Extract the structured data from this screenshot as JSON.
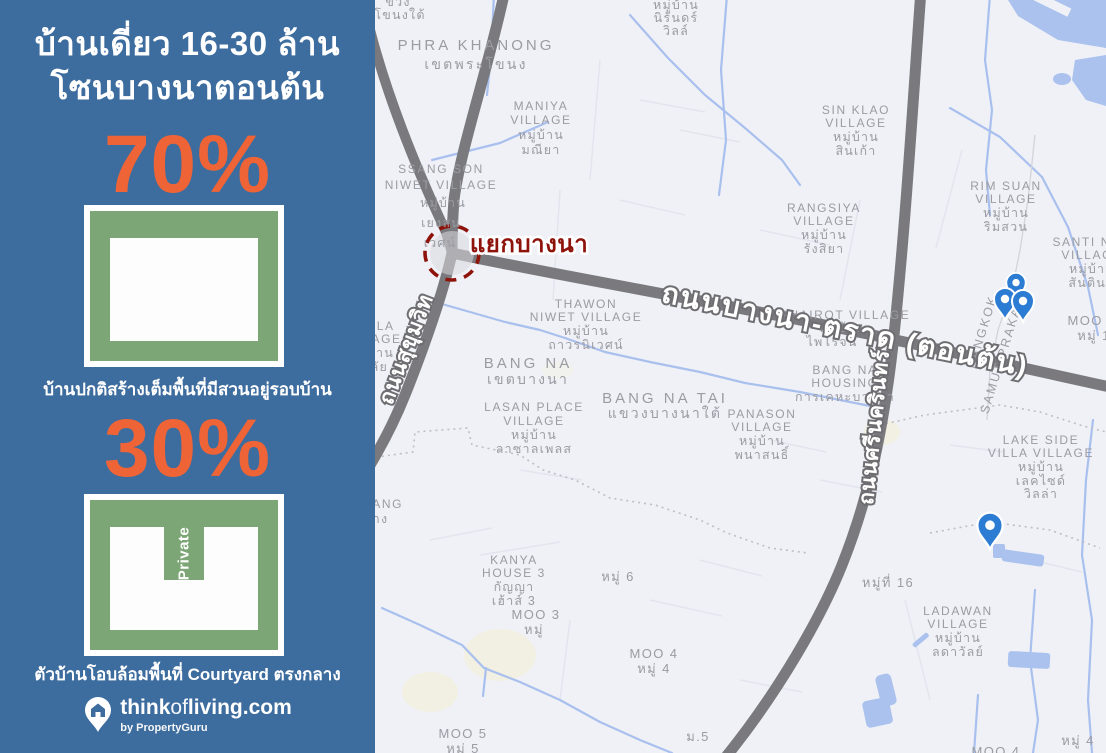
{
  "panel": {
    "title": {
      "line1": "บ้านเดี่ยว 16-30 ล้าน",
      "line2": "โซนบางนาตอนต้น"
    },
    "stats": [
      {
        "percent": "70%",
        "caption": "บ้านปกติสร้างเต็มพื้นที่มีสวนอยู่รอบบ้าน"
      },
      {
        "percent": "30%",
        "caption": "ตัวบ้านโอบล้อมพื้นที่ Courtyard ตรงกลาง",
        "courtyard_label": "Private"
      }
    ],
    "logo": {
      "part_bold1": "think",
      "part_light": "of",
      "part_bold2": "living",
      "part_domain": ".com",
      "byline": "by PropertyGuru"
    }
  },
  "map": {
    "junction": {
      "label": "แยกบางนา"
    },
    "roads": {
      "bangna_trat": "ถนนบางนา-ตราด (ตอนต้น)",
      "sukhumvit": "ถนนสุขุมวิท",
      "srinagarindra": "ถนนศรีนครินทร์"
    },
    "boundary": {
      "bangkok": "BANGKOK",
      "samut_prakan": "SAMUT PRAKAN"
    },
    "labels": {
      "phra_khanong_tai": [
        "ขวง",
        "โขนงใต้"
      ],
      "phra_khanong": [
        "PHRA KHANONG",
        "เขตพระโขนง"
      ],
      "maniya": [
        "MANIYA",
        "VILLAGE",
        "หมู่บ้าน",
        "มณียา"
      ],
      "nirun": [
        "หมู่บ้าน",
        "นิรันดร์",
        "วิลล์"
      ],
      "ssang_son": [
        "SSANG SON",
        "NIWET VILLAGE",
        "หมู่บ้าน",
        "เยงสน",
        "เวศน์"
      ],
      "thawon": [
        "THAWON",
        "NIWET VILLAGE",
        "หมู่บ้าน",
        "ถาวรนิเวศน์"
      ],
      "bang_na": [
        "BANG NA",
        "เขตบางนา"
      ],
      "lasan": [
        "LASAN PLACE",
        "VILLAGE",
        "หมู่บ้าน",
        "ลาซาลเพลส"
      ],
      "bang_na_tai": [
        "BANG NA TAI",
        "แขวงบางนาใต้"
      ],
      "panason": [
        "PANASON",
        "VILLAGE",
        "หมู่บ้าน",
        "พนาสนธิ์"
      ],
      "sin_klao": [
        "SIN KLAO",
        "VILLAGE",
        "หมู่บ้าน",
        "สินเก้า"
      ],
      "rangsiya": [
        "RANGSIYA",
        "VILLAGE",
        "หมู่บ้าน",
        "รังสิยา"
      ],
      "rim_suan": [
        "RIM SUAN",
        "VILLAGE",
        "หมู่บ้าน",
        "ริมสวน"
      ],
      "santi_nok": [
        "SANTI NOK",
        "VILLAGE",
        "หมู่บ้าน",
        "สันตินค"
      ],
      "phairot": [
        "PHAIROT VILLAGE",
        "หมู่บ้าน",
        "ไพโรจน์"
      ],
      "bangna_housing": [
        "BANG NA",
        "HOUSING",
        "การเคหะบางนา"
      ],
      "lake_side": [
        "LAKE SIDE",
        "VILLA VILLAGE",
        "หมู่บ้าน",
        "เลคไซด์",
        "วิลล่า"
      ],
      "ladawan": [
        "LADAWAN",
        "VILLAGE",
        "หมู่บ้าน",
        "ลดาวัลย์"
      ],
      "kanya": [
        "KANYA",
        "HOUSE 3",
        "กัญญา",
        "เฮ้าส์ 3"
      ],
      "phala": [
        "PHALA",
        "VILLAGE",
        "หมู่บ้าน",
        "ผาลัย"
      ],
      "sawang": [
        "SAWANG",
        "สว่าง"
      ],
      "moo1": [
        "MOO 1",
        "หมู่ 1"
      ],
      "moo3": [
        "MOO 3",
        "หมู่"
      ],
      "moo4": [
        "MOO 4",
        "หมู่ 4"
      ],
      "moo5": [
        "MOO 5",
        "หมู่ 5"
      ],
      "moo6": "หมู่ 6",
      "m5": "ม.5",
      "moo16": "หมู่ที่ 16",
      "moo4_right": "หมู่ 4",
      "moo4_bottom": "MOO 4"
    }
  },
  "colors": {
    "panel_blue": "#3d6c9e",
    "accent_orange": "#ee6437",
    "diagram_green": "#7ca676",
    "map_background": "#eff1f6",
    "road_gray": "#7a7a7e",
    "water_blue": "#abc2ee",
    "canal_blue": "#a9c0ee",
    "map_label_gray": "#9b9ba3",
    "junction_red": "#8e130b",
    "pin_blue": "#2d7cd3"
  }
}
